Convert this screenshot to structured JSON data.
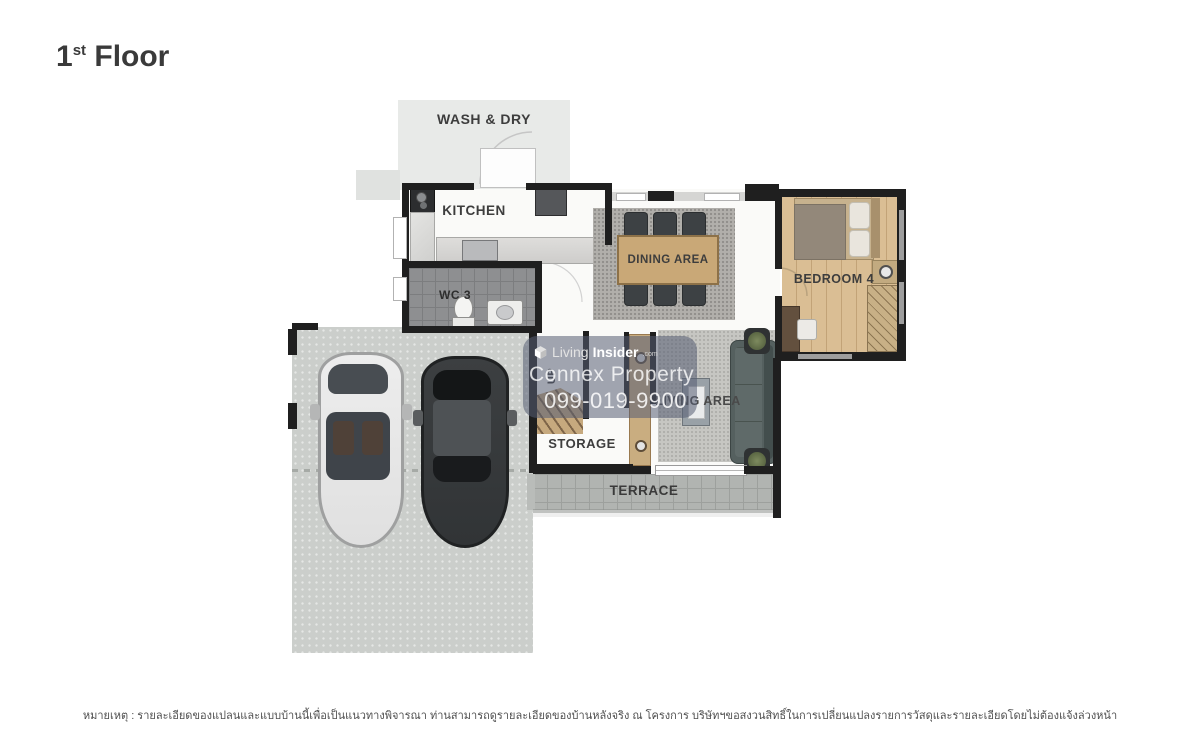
{
  "title": {
    "number": "1",
    "ordinal": "st",
    "word": "Floor"
  },
  "rooms": {
    "wash_dry": {
      "label": "WASH & DRY"
    },
    "kitchen": {
      "label": "KITCHEN"
    },
    "wc3": {
      "label": "WC 3"
    },
    "dining": {
      "label": "DINING AREA"
    },
    "bedroom4": {
      "label": "BEDROOM 4"
    },
    "living": {
      "label": "LIVING AREA"
    },
    "storage": {
      "label": "STORAGE"
    },
    "terrace": {
      "label": "TERRACE"
    },
    "stairs": {
      "label": "UP"
    }
  },
  "watermark": {
    "brand_first": "Living",
    "brand_second": "Insider",
    "brand_domain": ".com",
    "company": "Connex Property",
    "phone": "099-019-9900"
  },
  "footnote": {
    "text": "หมายเหตุ : รายละเอียดของแปลนและแบบบ้านนี้เพื่อเป็นแนวทางพิจารณา ท่านสามารถดูรายละเอียดของบ้านหลังจริง ณ โครงการ บริษัทฯขอสงวนสิทธิ์ในการเปลี่ยนแปลงรายการวัสดุและรายละเอียดโดยไม่ต้องแจ้งล่วงหน้า"
  },
  "colors": {
    "wall": "#1f1f1f",
    "wood": "#c9a877",
    "bedroom_floor": "#dabe94",
    "concrete": "#cbcecb",
    "terrace": "#b1b4b1",
    "watermark_overlay": "#5a6072",
    "label_text": "#3d3d3d"
  }
}
